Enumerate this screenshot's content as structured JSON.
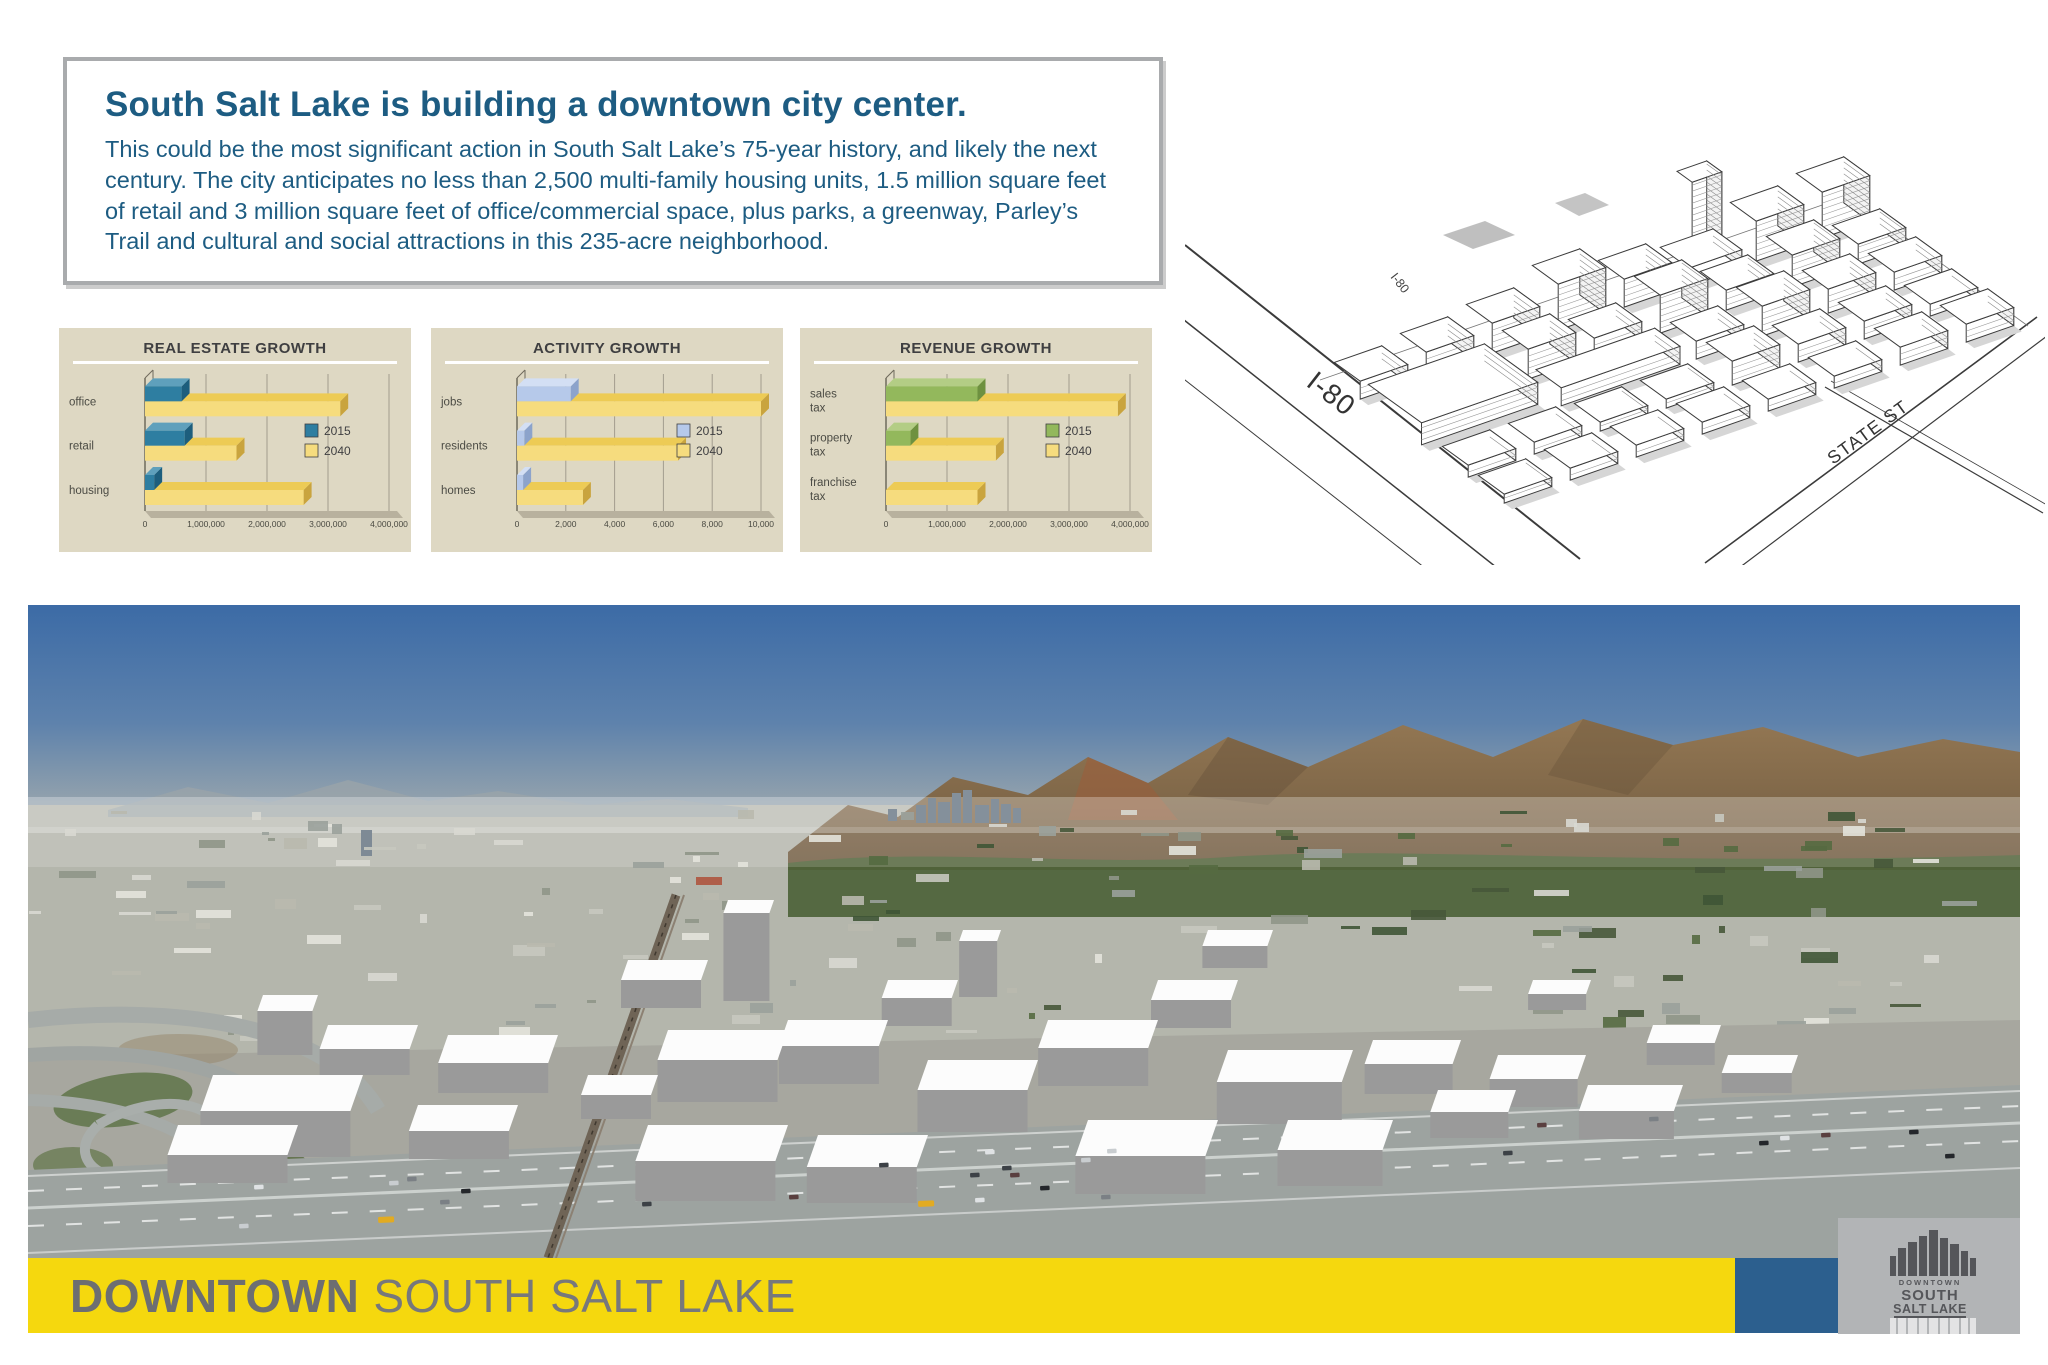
{
  "header": {
    "title": "South Salt Lake is building a downtown city center.",
    "body": "This could be the most significant action in South Salt Lake’s 75-year history, and likely the next century. The city anticipates no less than 2,500 multi-family housing units, 1.5 million square feet of retail and 3 million square feet of office/commercial space, plus parks, a greenway, Parley’s Trail and cultural and social attractions in this 235-acre neighborhood."
  },
  "chart_data": [
    {
      "type": "bar",
      "orientation": "horizontal",
      "title": "REAL ESTATE GROWTH",
      "categories": [
        "office",
        "retail",
        "housing"
      ],
      "series": [
        {
          "name": "2015",
          "color": "#2e7ea1",
          "top": "#5fa0bc",
          "side": "#1d5e7d",
          "values": [
            600000,
            650000,
            150000
          ]
        },
        {
          "name": "2040",
          "color": "#f6dc7e",
          "top": "#edcb55",
          "side": "#c9a43e",
          "values": [
            3200000,
            1500000,
            2600000
          ]
        }
      ],
      "xlim": [
        0,
        4000000
      ],
      "xticks": [
        "0",
        "1,000,000",
        "2,000,000",
        "3,000,000",
        "4,000,000"
      ],
      "legend_position": "right",
      "grid": true
    },
    {
      "type": "bar",
      "orientation": "horizontal",
      "title": "ACTIVITY GROWTH",
      "categories": [
        "jobs",
        "residents",
        "homes"
      ],
      "series": [
        {
          "name": "2015",
          "color": "#b6c9ea",
          "top": "#d3dff4",
          "side": "#8ca3cb",
          "values": [
            2200,
            300,
            250
          ]
        },
        {
          "name": "2040",
          "color": "#f6dc7e",
          "top": "#edcb55",
          "side": "#c9a43e",
          "values": [
            10000,
            6600,
            2700
          ]
        }
      ],
      "xlim": [
        0,
        10000
      ],
      "xticks": [
        "0",
        "2,000",
        "4,000",
        "6,000",
        "8,000",
        "10,000"
      ],
      "legend_position": "right",
      "grid": true
    },
    {
      "type": "bar",
      "orientation": "horizontal",
      "title": "REVENUE GROWTH",
      "categories": [
        "sales tax",
        "property tax",
        "franchise tax"
      ],
      "series": [
        {
          "name": "2015",
          "color": "#93b85c",
          "top": "#b3cd85",
          "side": "#6e9140",
          "values": [
            1500000,
            400000,
            0
          ]
        },
        {
          "name": "2040",
          "color": "#f6dc7e",
          "top": "#edcb55",
          "side": "#c9a43e",
          "values": [
            3800000,
            1800000,
            1500000
          ]
        }
      ],
      "xlim": [
        0,
        4000000
      ],
      "xticks": [
        "0",
        "1,000,000",
        "2,000,000",
        "3,000,000",
        "4,000,000"
      ],
      "legend_position": "right",
      "grid": true
    }
  ],
  "diagram": {
    "label_i80": "I-80",
    "label_i80_small": "I-80",
    "label_state_st": "STATE ST"
  },
  "footer": {
    "title_bold": "DOWNTOWN",
    "title_rest": "SOUTH SALT LAKE",
    "logo": {
      "top": "DOWNTOWN",
      "mid": "SOUTH",
      "bottom": "SALT LAKE"
    }
  },
  "colors": {
    "title_text": "#1d5c82",
    "panel_bg": "#ded8c3",
    "footer_yellow": "#f5d80e",
    "footer_blue": "#2c5f8e",
    "footer_gray": "#b2b4b6",
    "footer_text": "#6d6e71"
  }
}
